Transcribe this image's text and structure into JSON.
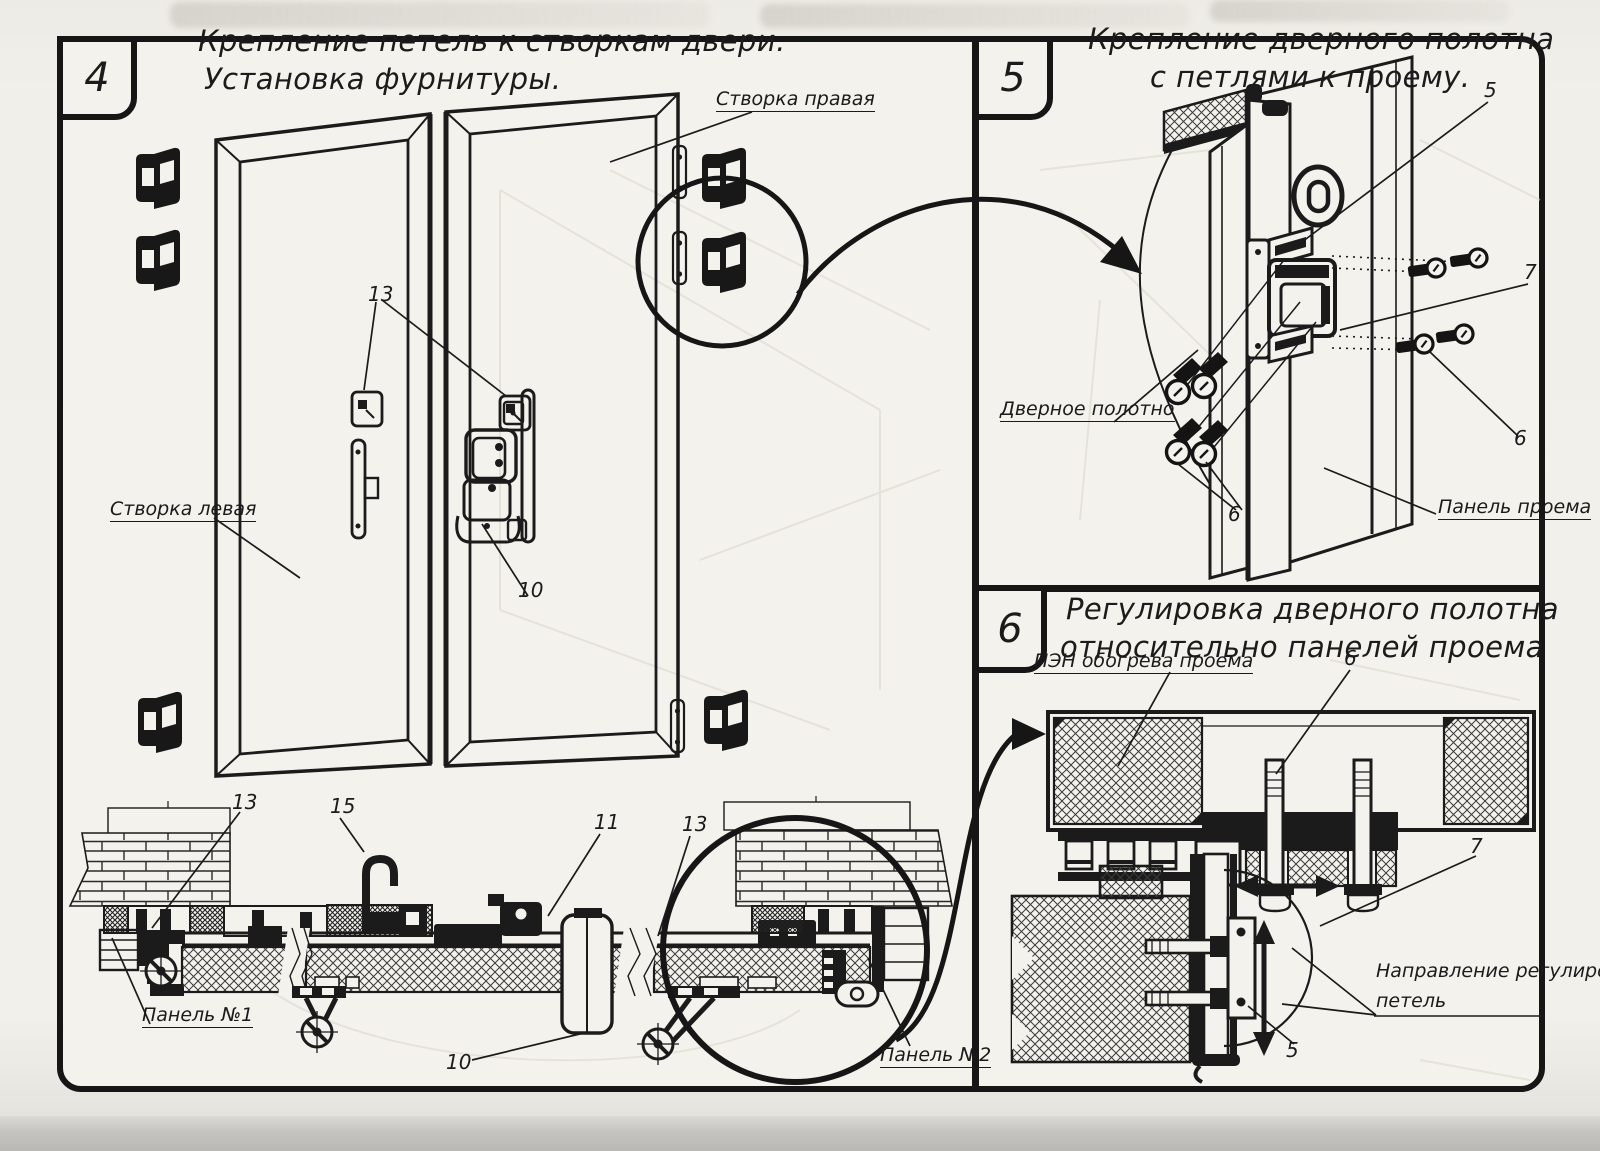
{
  "page": {
    "paper_color": "#f4f2ec",
    "ink_color": "#1b1b1b"
  },
  "sections": {
    "s4": {
      "number": "4",
      "title": [
        "Крепление петель к створкам двери.",
        "Установка фурнитуры."
      ]
    },
    "s5": {
      "number": "5",
      "title": [
        "Крепление дверного полотна",
        "с петлями к проему."
      ]
    },
    "s6": {
      "number": "6",
      "title": [
        "Регулировка дверного полотна",
        "относительно панелей проема"
      ]
    }
  },
  "labels": {
    "s4_right_leaf": "Створка правая",
    "s4_left_leaf": "Створка левая",
    "s4_panel_1": "Панель №1",
    "s4_panel_2": "Панель №2",
    "s5_door_leaf": "Дверное полотно",
    "s5_opening_panel": "Панель проема",
    "s6_heater": "ПЭН обогрева проема",
    "s6_adjust_line1": "Направление регулировки",
    "s6_adjust_line2": "петель"
  },
  "callouts": {
    "s4_handle_13": "13",
    "s4_latch_10": "10",
    "s4_sec_13_left": "13",
    "s4_sec_15": "15",
    "s4_sec_11": "11",
    "s4_sec_13_right": "13",
    "s4_sec_10": "10",
    "s5_num_5": "5",
    "s5_num_7": "7",
    "s5_num_6_right": "6",
    "s5_num_6_left": "6",
    "s6_num_6": "6",
    "s6_num_7": "7",
    "s6_num_5": "5"
  }
}
